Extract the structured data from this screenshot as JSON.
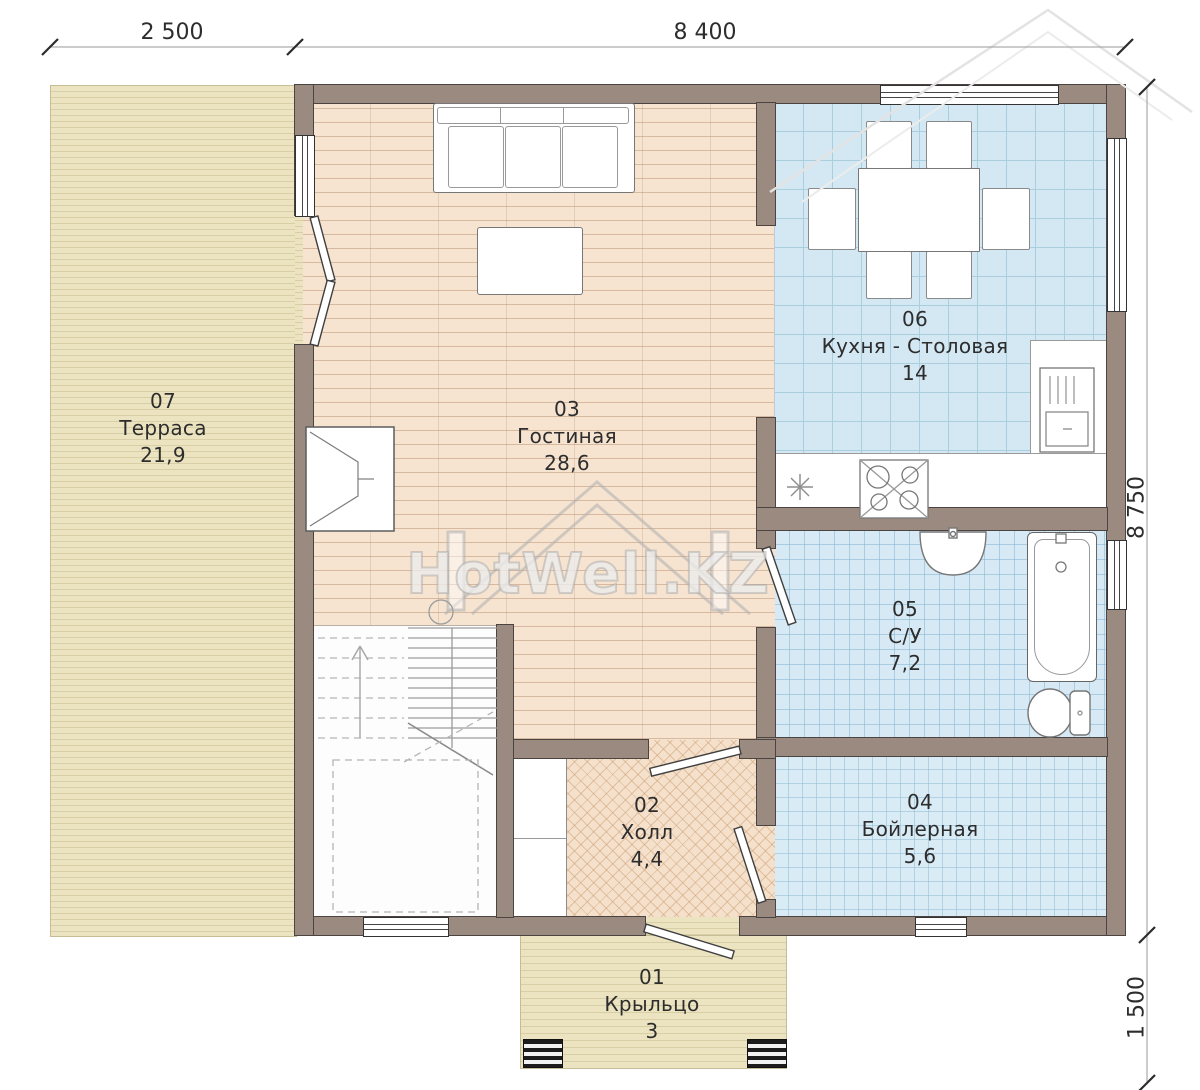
{
  "title": "Планировка 1 этажа",
  "watermark": {
    "text": "HotWell.KZ"
  },
  "dimensions": {
    "top_left": "2 500",
    "top_right": "8 400",
    "right_main": "8 750",
    "right_porch": "1 500"
  },
  "rooms": {
    "terrace": {
      "num": "07",
      "name": "Терраса",
      "area": "21,9"
    },
    "living": {
      "num": "03",
      "name": "Гостиная",
      "area": "28,6"
    },
    "kitchen": {
      "num": "06",
      "name": "Кухня - Столовая",
      "area": "14"
    },
    "bathroom": {
      "num": "05",
      "name": "С/У",
      "area": "7,2"
    },
    "boiler": {
      "num": "04",
      "name": "Бойлерная",
      "area": "5,6"
    },
    "hall": {
      "num": "02",
      "name": "Холл",
      "area": "4,4"
    },
    "porch": {
      "num": "01",
      "name": "Крыльцо",
      "area": "3"
    }
  },
  "colors": {
    "wall": "#9a8a7f",
    "terrace": "#ece4c1",
    "wood_floor": "#f6e4d1",
    "tile_floor": "#d4e8f3",
    "hall_floor": "#f4e0cb"
  }
}
